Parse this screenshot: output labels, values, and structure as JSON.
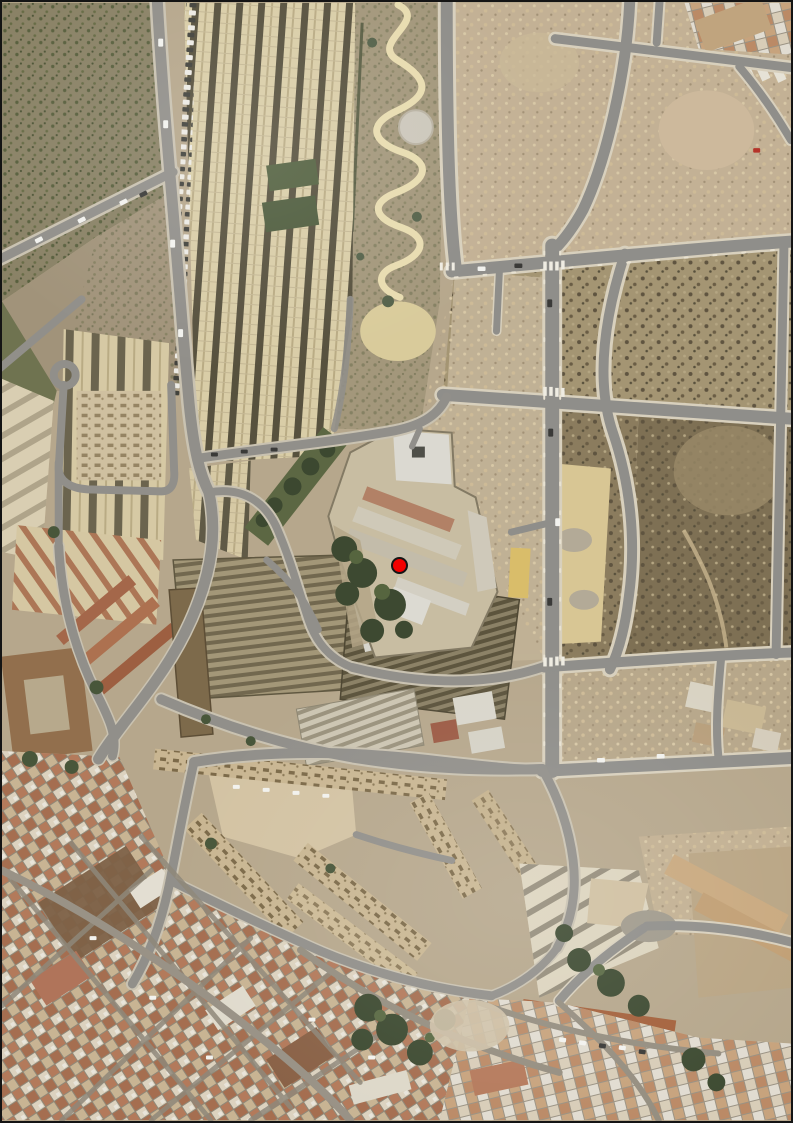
{
  "meta": {
    "title": "Aerial map view of urban area with location marker",
    "width_px": 793,
    "height_px": 1123,
    "border_color": "#141414"
  },
  "marker": {
    "name": "location-marker",
    "x": 397,
    "y": 563,
    "diameter_px": 17,
    "fill": "#f20000",
    "outline": "#151515"
  },
  "map_features": [
    "scrub field (north-west)",
    "terraced housing rows (north)",
    "park with winding path and circular plaza (north-centre)",
    "new road grid with vacant plots (east)",
    "walled compound with long buildings and trees (centre, marked)",
    "industrial warehouses (centre-west)",
    "apartment blocks (west)",
    "housing estate around dirt courtyard (south-centre)",
    "old town with terracotta roofs (south-west)",
    "open ground (south-east)"
  ],
  "palette": {
    "ground_tan": "#b6a78c",
    "field_olive": "#8a8266",
    "scrub_dark": "#84765a",
    "road_asphalt": "#8f8e8a",
    "sidewalk": "#d8d0bd",
    "rowhouse_cream": "#d9cda7",
    "warehouse_rib": "#72684f",
    "roof_terracotta": "#b37a5b",
    "tree_green": "#3e4b32",
    "sand_yellow": "#d8c694",
    "marker_red": "#f20000"
  }
}
